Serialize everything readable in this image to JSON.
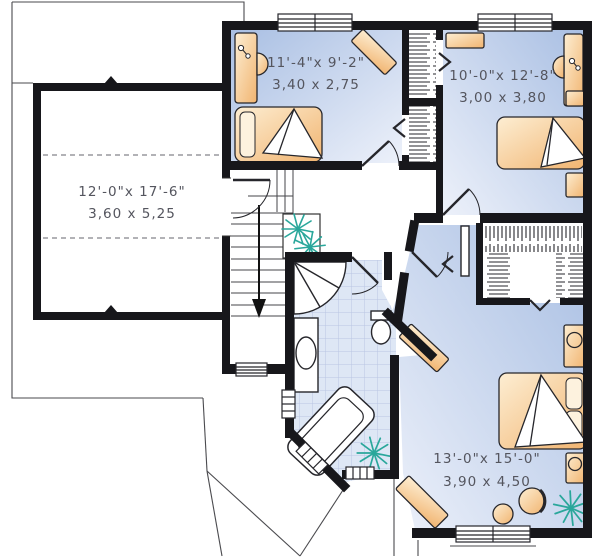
{
  "plan": {
    "type": "second-floor-plan",
    "rooms": [
      {
        "id": "side-attic-room",
        "imperial": "12'-0\"x 17'-6\"",
        "metric": "3,60 x 5,25"
      },
      {
        "id": "bedroom-1",
        "imperial": "11'-4\"x 9'-2\"",
        "metric": "3,40 x 2,75"
      },
      {
        "id": "bedroom-2",
        "imperial": "10'-0\"x 12'-8\"",
        "metric": "3,00 x 3,80"
      },
      {
        "id": "master-bedroom",
        "imperial": "13'-0\"x 15'-0\"",
        "metric": "3,90 x 4,50"
      }
    ],
    "colors": {
      "wall": "#17171b",
      "floor_blue_dark": "#a9bfe3",
      "floor_blue_light": "#edf1fa",
      "furniture_dark": "#f1b470",
      "furniture_light": "#fdeed3",
      "tile_line": "#b9c6e2",
      "plant": "#2aa79b",
      "label_text": "#54555e"
    }
  }
}
